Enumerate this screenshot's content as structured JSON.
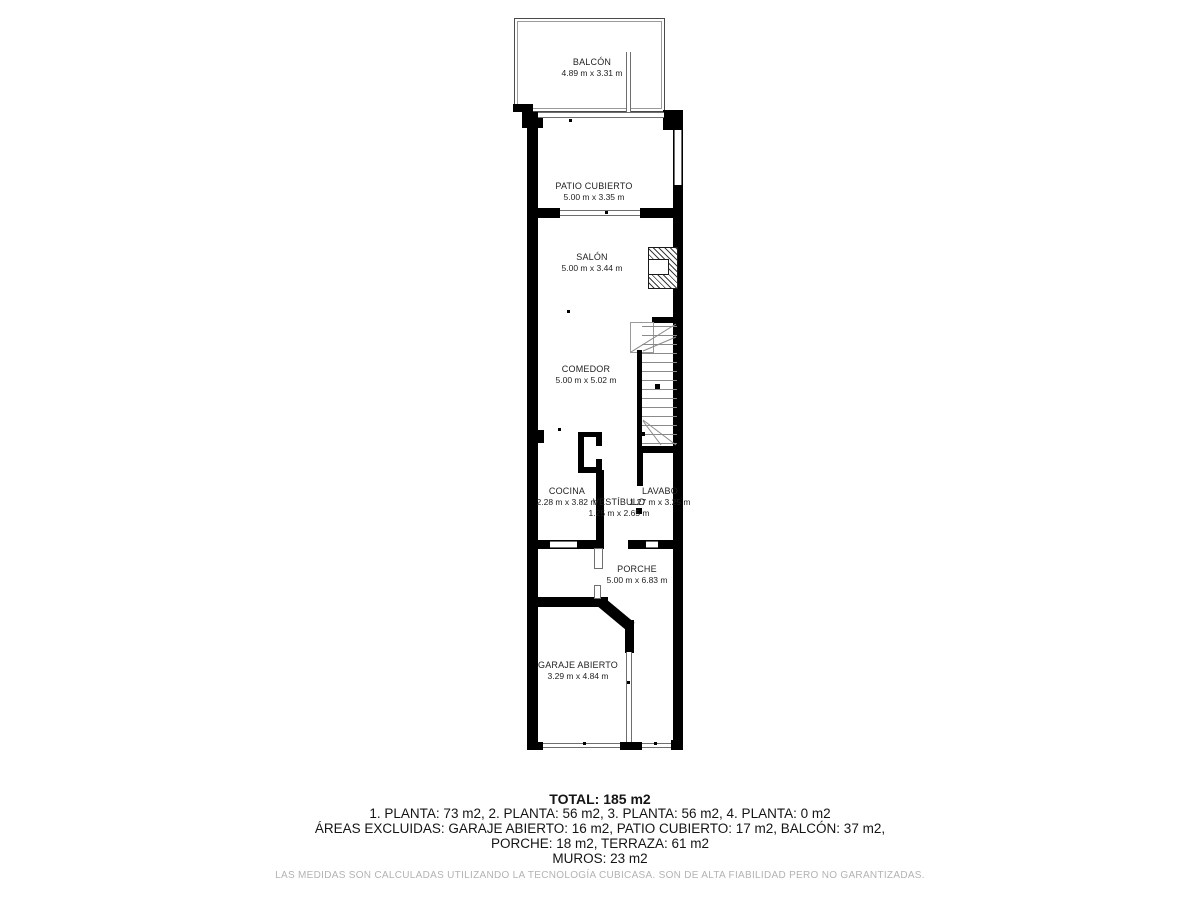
{
  "plan": {
    "rooms": [
      {
        "name": "BALCÓN",
        "dims": "4.89 m x 3.31 m"
      },
      {
        "name": "PATIO CUBIERTO",
        "dims": "5.00 m x 3.35 m"
      },
      {
        "name": "SALÓN",
        "dims": "5.00 m x 3.44 m"
      },
      {
        "name": "COMEDOR",
        "dims": "5.00 m x 5.02 m"
      },
      {
        "name": "COCINA",
        "dims": "2.28 m x 3.82 m"
      },
      {
        "name": "VESTÍBULO",
        "dims": "1.25 m x 2.65 m"
      },
      {
        "name": "LAVABO",
        "dims": "1.27 m x 3.25 m"
      },
      {
        "name": "PORCHE",
        "dims": "5.00 m x 6.83 m"
      },
      {
        "name": "GARAJE ABIERTO",
        "dims": "3.29 m x 4.84 m"
      }
    ]
  },
  "summary": {
    "total": "TOTAL: 185 m2",
    "plantas": "1. PLANTA: 73 m2, 2. PLANTA: 56 m2, 3. PLANTA: 56 m2, 4. PLANTA: 0 m2",
    "excluidas_line1": "ÁREAS EXCLUIDAS: GARAJE ABIERTO: 16 m2, PATIO CUBIERTO: 17 m2, BALCÓN: 37 m2,",
    "excluidas_line2": "PORCHE: 18 m2, TERRAZA: 61 m2",
    "muros": "MUROS: 23 m2"
  },
  "disclaimer": "LAS MEDIDAS SON CALCULADAS UTILIZANDO LA TECNOLOGÍA CUBICASA. SON DE ALTA FIABILIDAD PERO NO GARANTIZADAS.",
  "colors": {
    "wall": "#000000",
    "text": "#141414",
    "muted": "#b3b3b3"
  }
}
